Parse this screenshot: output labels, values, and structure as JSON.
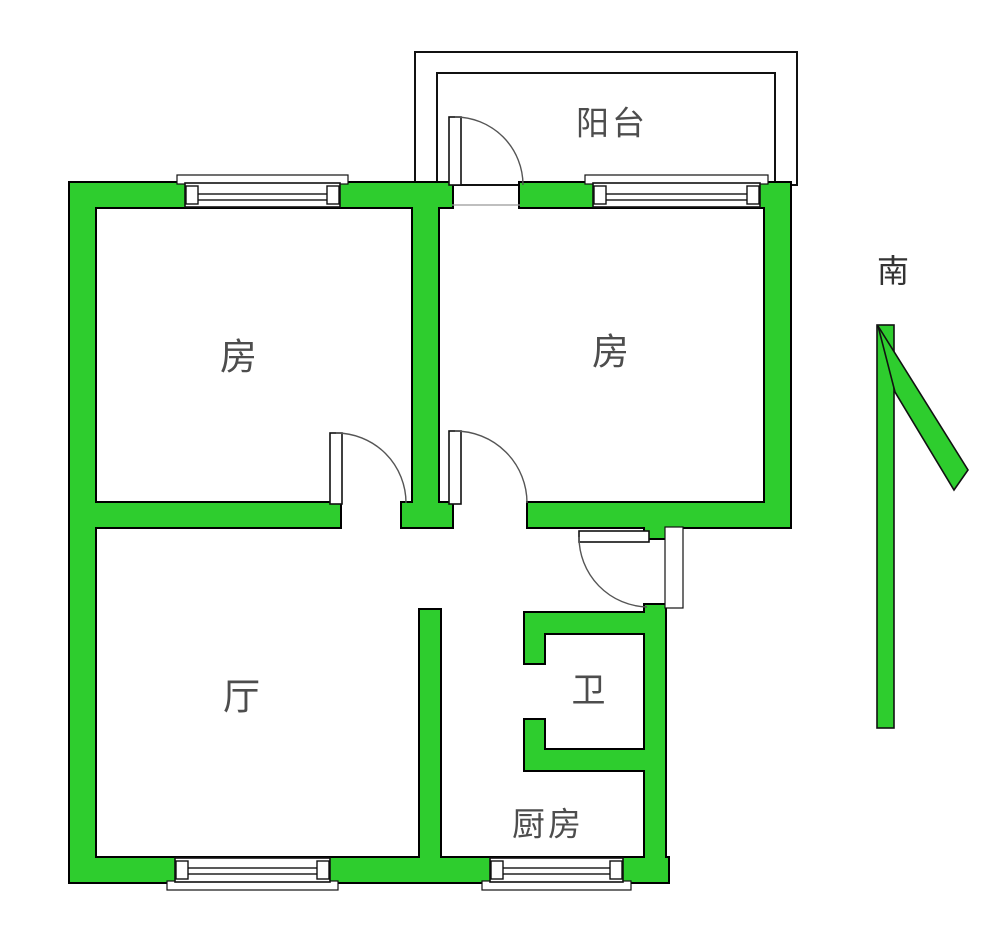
{
  "floorplan": {
    "rooms": {
      "balcony": {
        "label": "阳台"
      },
      "bedroom_left": {
        "label": "房"
      },
      "bedroom_right": {
        "label": "房"
      },
      "living_room": {
        "label": "厅"
      },
      "bathroom": {
        "label": "卫"
      },
      "kitchen": {
        "label": "厨房"
      }
    },
    "compass": {
      "south_label": "南"
    },
    "colors": {
      "wall_green": "#2ecd2e",
      "outline": "#000000",
      "label_gray": "#4d4d4d",
      "compass_text": "#333333",
      "background": "#ffffff"
    }
  }
}
